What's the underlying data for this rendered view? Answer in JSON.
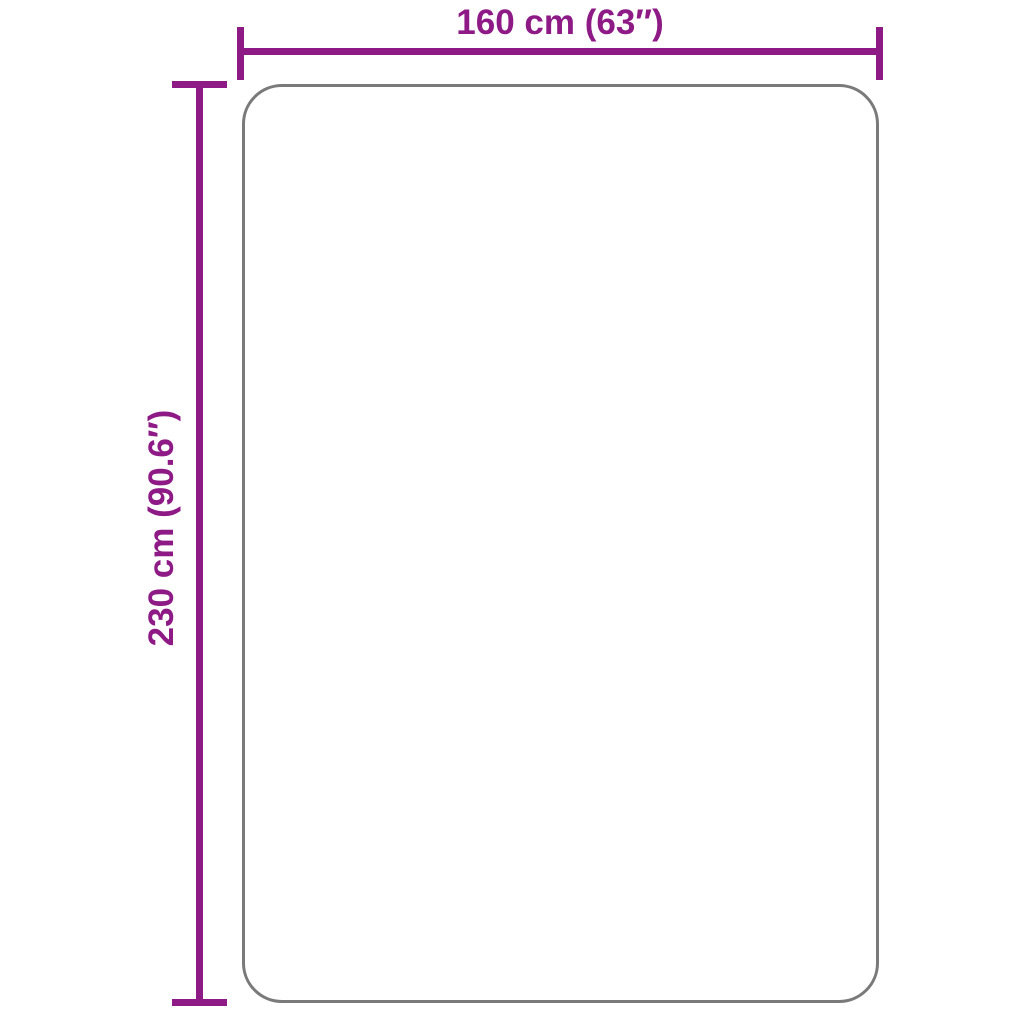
{
  "diagram": {
    "type": "product-dimension-diagram",
    "product": "rug",
    "dimensions": {
      "width": {
        "label": "160 cm (63″)",
        "cm": 160,
        "inches": 63
      },
      "height": {
        "label": "230 cm (90.6″)",
        "cm": 230,
        "inches": 90.6
      }
    }
  },
  "colors": {
    "dimension_lines": "#8E1A86",
    "product_outline": "#7A7A7A",
    "background": "#FFFFFF"
  }
}
